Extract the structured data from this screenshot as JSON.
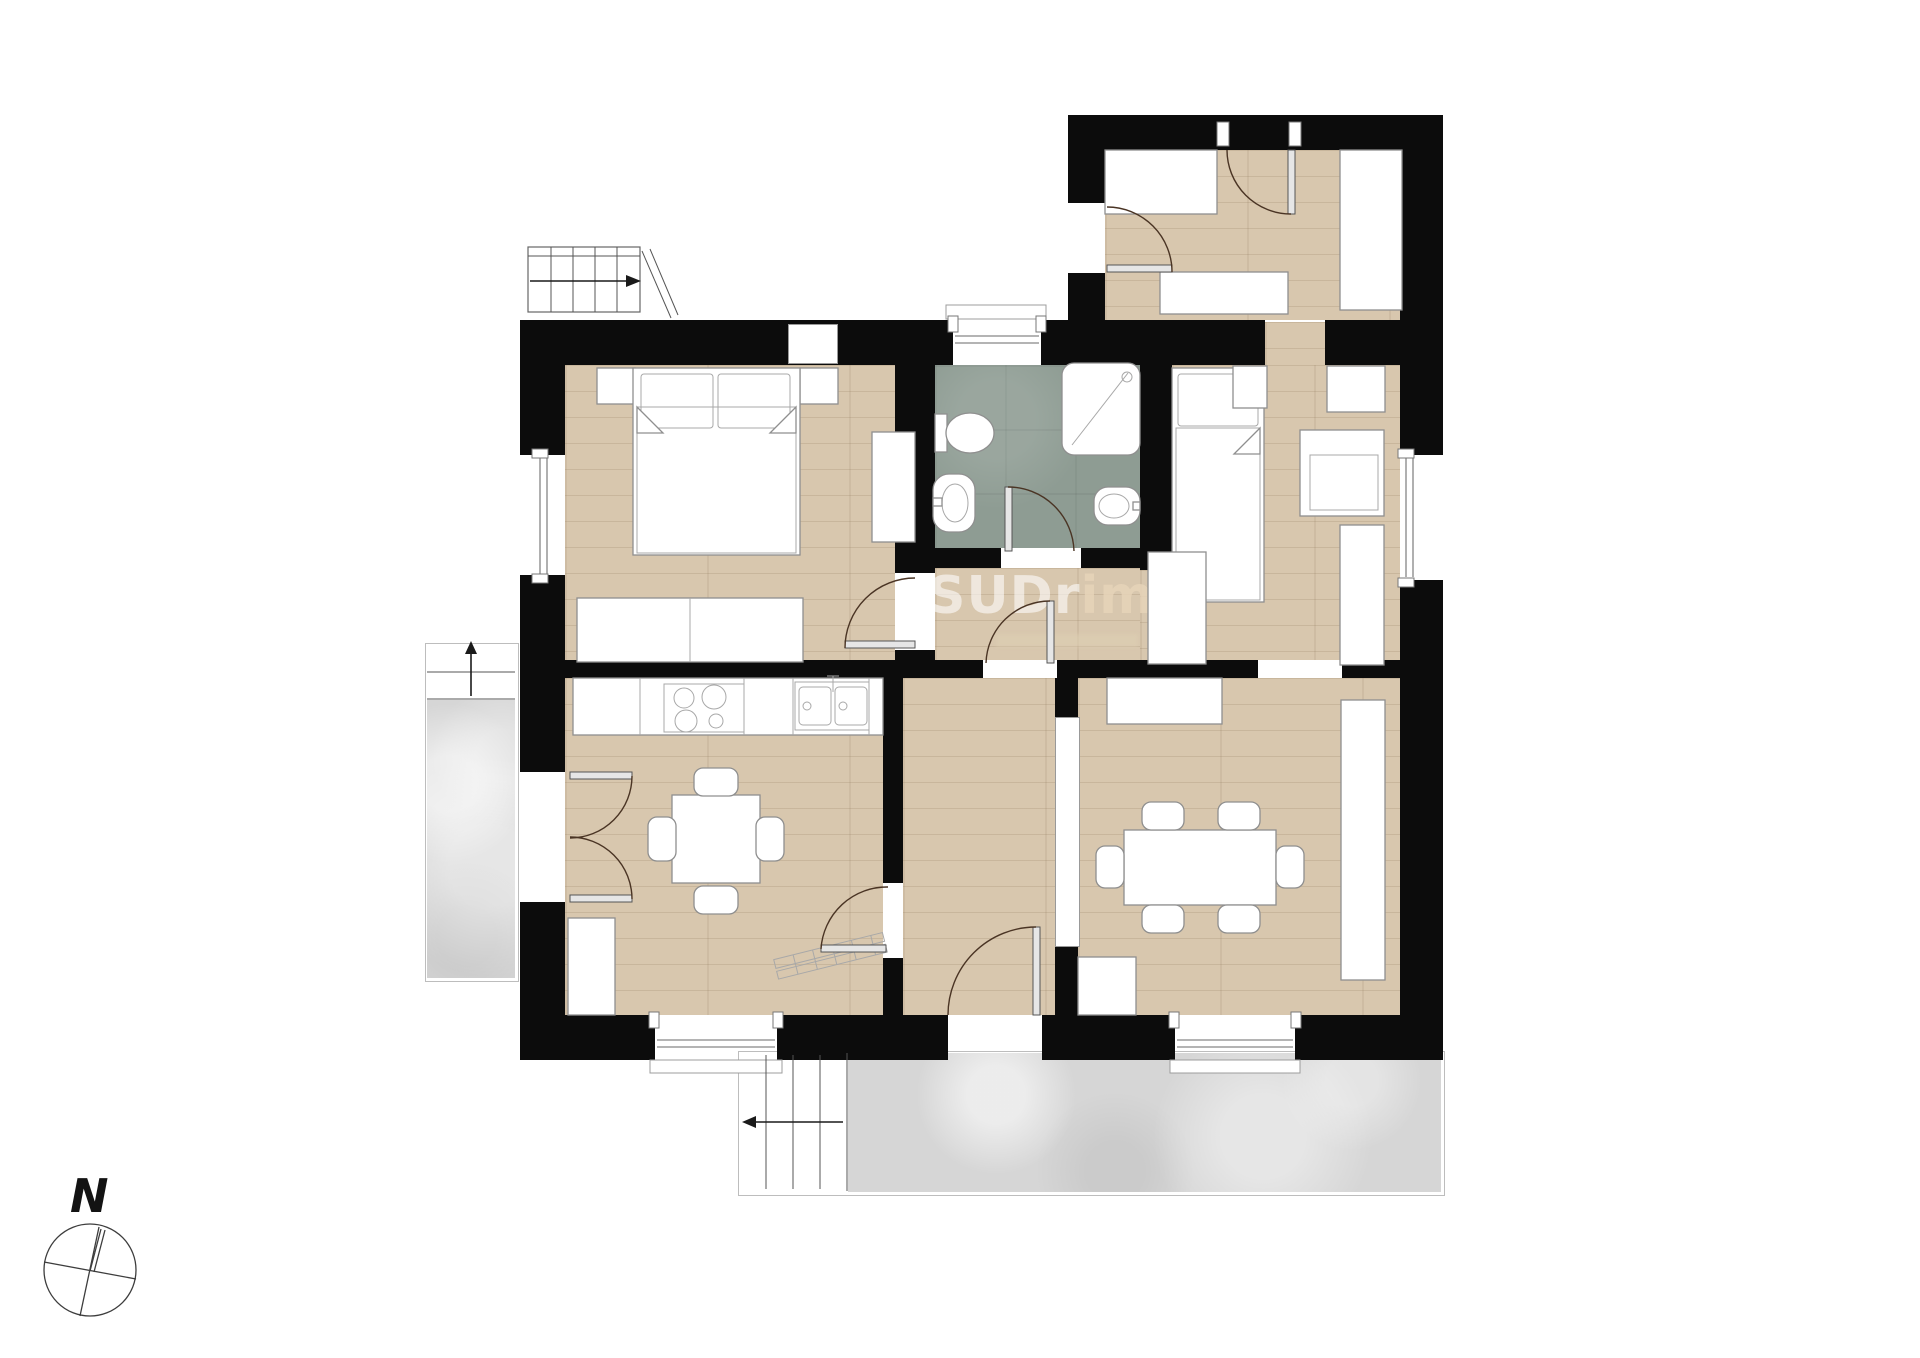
{
  "page": {
    "width": 1920,
    "height": 1358,
    "background": "#ffffff"
  },
  "watermark": {
    "part1": "SUDr",
    "part2": "imm"
  },
  "compass": {
    "label": "N"
  },
  "colors": {
    "wall": "#0c0c0c",
    "wood": "#d8c7ae",
    "bath": "#8e9c93",
    "terrace": "#d6d6d6",
    "terrace_border": "#bdbdbd",
    "outline": "#8f8f8f",
    "door_arc": "#4a3424",
    "door_leaf": "#e6e6e6",
    "frame": "#9c9c9c",
    "arrow": "#1a1a1a"
  },
  "rooms": [
    {
      "id": "entry-hall",
      "floor": "wood"
    },
    {
      "id": "bedroom-1",
      "floor": "wood"
    },
    {
      "id": "bathroom",
      "floor": "tile"
    },
    {
      "id": "bedroom-2",
      "floor": "wood"
    },
    {
      "id": "inner-hall",
      "floor": "wood"
    },
    {
      "id": "kitchen-dining",
      "floor": "wood"
    },
    {
      "id": "corridor",
      "floor": "wood"
    },
    {
      "id": "living-dining",
      "floor": "wood"
    },
    {
      "id": "terrace-left",
      "floor": "stone"
    },
    {
      "id": "terrace-bottom",
      "floor": "stone"
    }
  ]
}
